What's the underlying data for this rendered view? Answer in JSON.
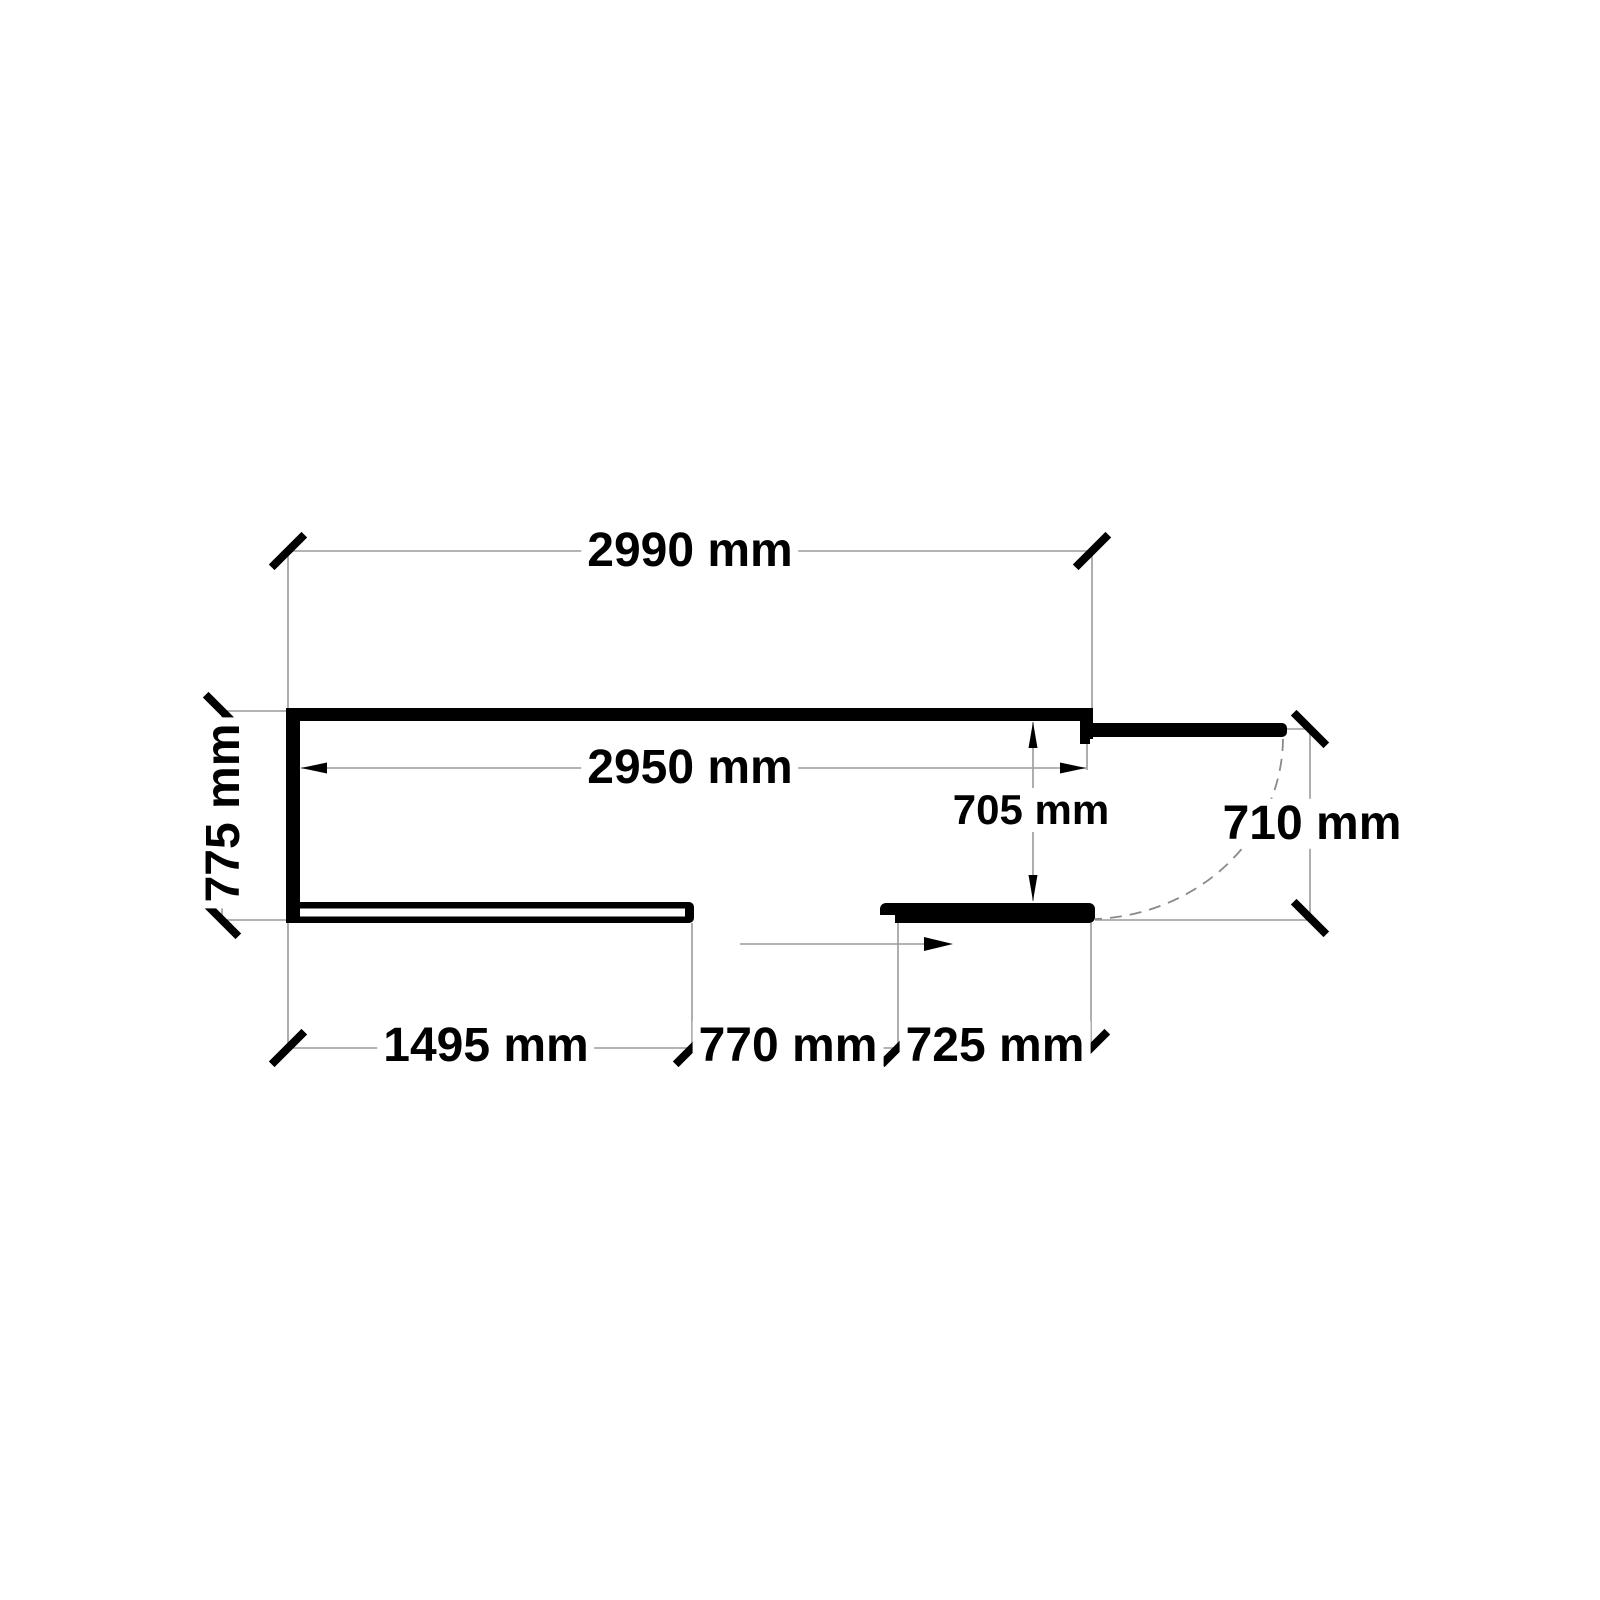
{
  "page": {
    "background": "#ffffff"
  },
  "drawing": {
    "type": "floor-plan-dimension-drawing",
    "unit": "mm",
    "dimension_labels": {
      "overall_top": "2990 mm",
      "inner_clear_width": "2950 mm",
      "left_side_depth": "775 mm",
      "recess_depth": "705 mm",
      "right_side_opening": "710 mm",
      "bottom_left_wall": "1495 mm",
      "bottom_opening": "770 mm",
      "bottom_right_wall": "725 mm"
    },
    "colors": {
      "wall_fill": "#000000",
      "dimension_line": "#9a9a9a",
      "door_swing_dash": "#8a8a8a",
      "tick_and_arrow": "#000000",
      "label_text": "#000000",
      "label_halo": "#ffffff"
    }
  }
}
